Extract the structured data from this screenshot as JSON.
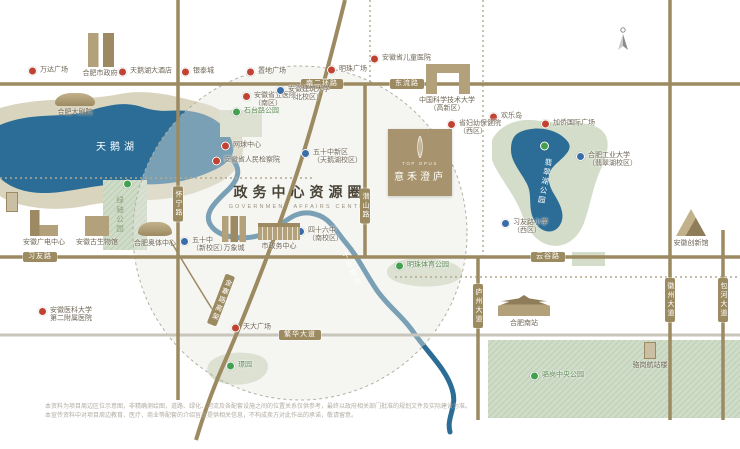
{
  "map": {
    "title": "政务中心资源圈",
    "subtitle": "GOVERNMENT AFFAIRS CENTER",
    "logo": {
      "en": "TOP OPUS",
      "zh": "意禾澄庐"
    },
    "swan_lake_label": "天鹅湖",
    "area_labels": [
      {
        "text": "绿轴公园",
        "x": 120,
        "y": 196,
        "color": "#8aa07b",
        "rotate": 0
      },
      {
        "text": "翡翠湖公园",
        "x": 545,
        "y": 158,
        "color": "#ffffff",
        "rotate": 10
      },
      {
        "text": "十五里河",
        "x": 352,
        "y": 250,
        "color": "#ffffff",
        "rotate": -22
      }
    ],
    "road_badges": [
      {
        "text": "南二环路",
        "x": 322,
        "y": 84,
        "vertical": false,
        "rotate": 0
      },
      {
        "text": "东流路",
        "x": 407,
        "y": 84,
        "vertical": false,
        "rotate": 0
      },
      {
        "text": "习友路",
        "x": 40,
        "y": 257,
        "vertical": false,
        "rotate": 0
      },
      {
        "text": "云谷路",
        "x": 548,
        "y": 257,
        "vertical": false,
        "rotate": 0
      },
      {
        "text": "繁华大道",
        "x": 300,
        "y": 335,
        "vertical": false,
        "rotate": 0
      },
      {
        "text": "怀宁路",
        "x": 178,
        "y": 204,
        "vertical": true,
        "rotate": 0
      },
      {
        "text": "潜山路",
        "x": 365,
        "y": 206,
        "vertical": true,
        "rotate": 0
      },
      {
        "text": "庐州大道",
        "x": 478,
        "y": 306,
        "vertical": true,
        "rotate": 0
      },
      {
        "text": "徽州大道",
        "x": 670,
        "y": 300,
        "vertical": true,
        "rotate": 0
      },
      {
        "text": "包河大道",
        "x": 723,
        "y": 300,
        "vertical": true,
        "rotate": 0
      },
      {
        "text": "金寨路高架",
        "x": 221,
        "y": 300,
        "vertical": true,
        "rotate": 21
      }
    ],
    "markers": [
      {
        "type": "red",
        "x": 28,
        "y": 71,
        "lines": [
          "万达广场"
        ]
      },
      {
        "type": "red",
        "x": 118,
        "y": 72,
        "lines": [
          "天鹅湖大酒店"
        ]
      },
      {
        "type": "red",
        "x": 181,
        "y": 72,
        "lines": [
          "银泰城"
        ]
      },
      {
        "type": "red",
        "x": 246,
        "y": 72,
        "lines": [
          "置地广场"
        ]
      },
      {
        "type": "red",
        "x": 327,
        "y": 70,
        "lines": [
          "明珠广场"
        ]
      },
      {
        "type": "red",
        "x": 370,
        "y": 59,
        "lines": [
          "安徽省儿童医院"
        ]
      },
      {
        "type": "red",
        "x": 489,
        "y": 117,
        "lines": [
          "欢乐岛"
        ]
      },
      {
        "type": "red",
        "x": 541,
        "y": 124,
        "lines": [
          "加侨国际广场"
        ]
      },
      {
        "type": "red",
        "x": 242,
        "y": 100,
        "lines": [
          "安徽省立医院",
          "（南区）"
        ]
      },
      {
        "type": "red",
        "x": 447,
        "y": 128,
        "lines": [
          "省妇幼保健院",
          "（西区）"
        ]
      },
      {
        "type": "red",
        "x": 221,
        "y": 146,
        "lines": [
          "网球中心"
        ]
      },
      {
        "type": "red",
        "x": 212,
        "y": 161,
        "lines": [
          "安徽省人民检察院"
        ]
      },
      {
        "type": "red",
        "x": 231,
        "y": 328,
        "lines": [
          "天大广场"
        ]
      },
      {
        "type": "red",
        "x": 38,
        "y": 315,
        "lines": [
          "安徽医科大学",
          "第二附属医院"
        ]
      },
      {
        "type": "blue",
        "x": 276,
        "y": 94,
        "lines": [
          "安徽建筑大学",
          "（北校区）"
        ]
      },
      {
        "type": "blue",
        "x": 301,
        "y": 157,
        "lines": [
          "五十中新区",
          "（天鹅湖校区）"
        ]
      },
      {
        "type": "blue",
        "x": 296,
        "y": 235,
        "lines": [
          "四十六中",
          "（南校区）"
        ]
      },
      {
        "type": "blue",
        "x": 180,
        "y": 245,
        "lines": [
          "五十中",
          "（新校区）"
        ]
      },
      {
        "type": "blue",
        "x": 501,
        "y": 227,
        "lines": [
          "习友路小学",
          "（西区）"
        ]
      },
      {
        "type": "blue",
        "x": 576,
        "y": 160,
        "lines": [
          "合肥工业大学",
          "（翡翠湖校区）"
        ]
      },
      {
        "type": "green",
        "x": 123,
        "y": 184,
        "lines": []
      },
      {
        "type": "green",
        "x": 540,
        "y": 146,
        "lines": []
      },
      {
        "type": "green",
        "x": 232,
        "y": 112,
        "lines": [
          "石台路公园"
        ]
      },
      {
        "type": "green",
        "x": 395,
        "y": 266,
        "lines": [
          "明珠体育公园"
        ]
      },
      {
        "type": "green",
        "x": 226,
        "y": 366,
        "lines": [
          "璟园"
        ]
      },
      {
        "type": "green",
        "x": 530,
        "y": 376,
        "lines": [
          "骆岗中央公园"
        ]
      }
    ],
    "buildings": [
      {
        "variant": "twin",
        "x": 88,
        "y": 33,
        "w": 26,
        "h": 34,
        "label": "合肥市政府",
        "label2": "",
        "lx": 100,
        "ly": 70
      },
      {
        "variant": "dome",
        "x": 55,
        "y": 93,
        "w": 40,
        "h": 13,
        "label": "合肥大剧院",
        "label2": "",
        "lx": 75,
        "ly": 109
      },
      {
        "variant": "gate",
        "x": 426,
        "y": 64,
        "w": 44,
        "h": 30,
        "label": "中国科学技术大学",
        "label2": "（高新区）",
        "lx": 447,
        "ly": 97
      },
      {
        "variant": "ltower",
        "x": 30,
        "y": 210,
        "w": 28,
        "h": 26,
        "label": "安徽广电中心",
        "label2": "",
        "lx": 44,
        "ly": 239
      },
      {
        "variant": "box",
        "x": 85,
        "y": 216,
        "w": 24,
        "h": 20,
        "label": "安徽古生物馆",
        "label2": "",
        "lx": 97,
        "ly": 239
      },
      {
        "variant": "stadium",
        "x": 138,
        "y": 222,
        "w": 34,
        "h": 14,
        "label": "合肥奥体中心",
        "label2": "",
        "lx": 155,
        "ly": 240
      },
      {
        "variant": "towers",
        "x": 222,
        "y": 216,
        "w": 24,
        "h": 26,
        "label": "万象城",
        "label2": "",
        "lx": 234,
        "ly": 245
      },
      {
        "variant": "hall",
        "x": 258,
        "y": 223,
        "w": 42,
        "h": 17,
        "label": "市政务中心",
        "label2": "",
        "lx": 279,
        "ly": 243
      },
      {
        "variant": "pyramid",
        "x": 676,
        "y": 209,
        "w": 30,
        "h": 27,
        "label": "安徽创新馆",
        "label2": "",
        "lx": 691,
        "ly": 240
      },
      {
        "variant": "palace",
        "x": 498,
        "y": 295,
        "w": 52,
        "h": 21,
        "label": "合肥南站",
        "label2": "",
        "lx": 524,
        "ly": 320
      },
      {
        "variant": "small",
        "x": 644,
        "y": 342,
        "w": 12,
        "h": 17,
        "label": "骆岗航站楼",
        "label2": "",
        "lx": 650,
        "ly": 362
      },
      {
        "variant": "small",
        "x": 6,
        "y": 192,
        "w": 12,
        "h": 20,
        "label": "",
        "label2": "",
        "lx": 0,
        "ly": 0
      }
    ],
    "disclaimer": [
      "本资料为项目周边区位示意图，非精确测绘图，道路、绿化、河流及各配套设施之间的位置关系仅供参考，最终以政府相关部门批准的规划文件及实际建设为准。",
      "本宣传资料中对项目周边教育、医疗、商业等配套的介绍旨在提供相关信息，不构成卖方对此作出的承诺，敬请留意。"
    ]
  }
}
